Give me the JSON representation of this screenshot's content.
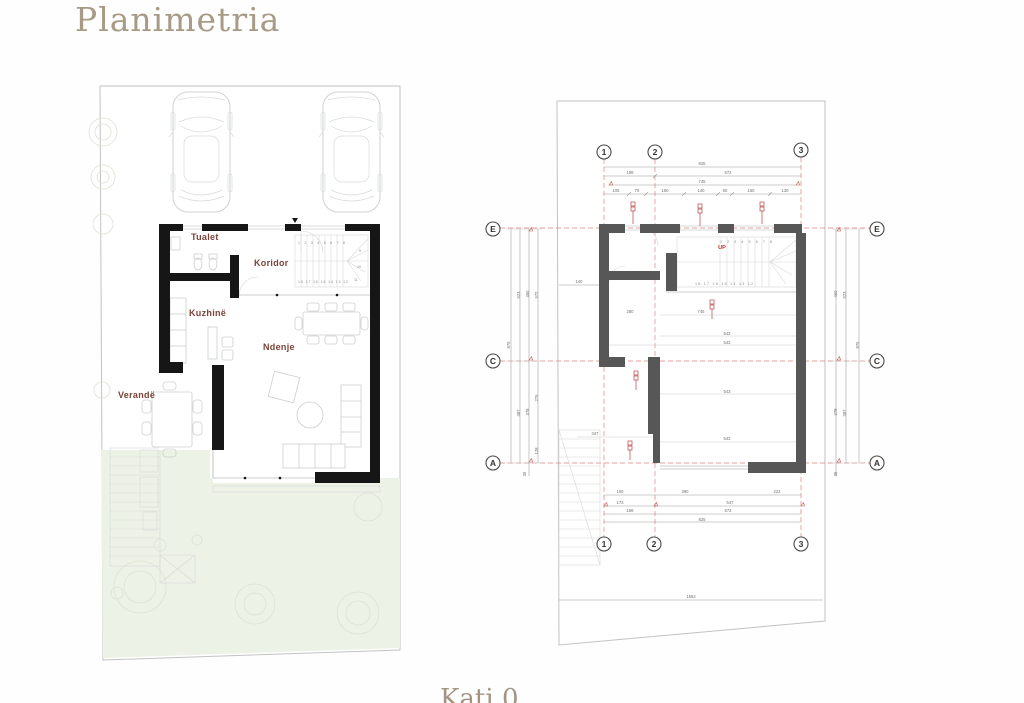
{
  "page": {
    "title": "Planimetria",
    "caption": "Kati 0",
    "colors": {
      "accent": "#a89b86",
      "room_label": "#7a4238",
      "grid_red": "#e08080",
      "tag_red": "#b84040",
      "left_plan_wall": "#161616",
      "right_plan_wall": "#575757",
      "lawn": "#edf2e6"
    }
  },
  "left_plan": {
    "room_labels": [
      "Tualet",
      "Koridor",
      "Kuzhinë",
      "Ndenje",
      "Verandë"
    ],
    "stair_top": "1 2 3 4 5 6 7 8",
    "stair_bottom": "18 17 16 15 14 13 12",
    "stair_side": [
      "9",
      "10",
      "11"
    ]
  },
  "right_plan": {
    "grid_columns": [
      "1",
      "2",
      "3"
    ],
    "grid_rows": [
      "E",
      "C",
      "A"
    ],
    "up_label": "UP",
    "stair_top": "1 2 3 4 5 6 7 8",
    "stair_bottom": "18 17 16 15 14 13 12",
    "dims": [
      {
        "t": "825",
        "x": 222,
        "y": 70
      },
      {
        "t": "198",
        "x": 150,
        "y": 79
      },
      {
        "t": "572",
        "x": 248,
        "y": 79
      },
      {
        "t": "745",
        "x": 222,
        "y": 88
      },
      {
        "t": "105",
        "x": 136,
        "y": 97
      },
      {
        "t": "70",
        "x": 157,
        "y": 97
      },
      {
        "t": "160",
        "x": 185,
        "y": 97
      },
      {
        "t": "140",
        "x": 221,
        "y": 97
      },
      {
        "t": "60",
        "x": 245,
        "y": 97
      },
      {
        "t": "160",
        "x": 271,
        "y": 97
      },
      {
        "t": "130",
        "x": 305,
        "y": 97
      },
      {
        "t": "100",
        "x": 140,
        "y": 398
      },
      {
        "t": "390",
        "x": 205,
        "y": 398
      },
      {
        "t": "222",
        "x": 297,
        "y": 398
      },
      {
        "t": "173",
        "x": 140,
        "y": 409
      },
      {
        "t": "547",
        "x": 250,
        "y": 409
      },
      {
        "t": "198",
        "x": 150,
        "y": 417
      },
      {
        "t": "572",
        "x": 248,
        "y": 417
      },
      {
        "t": "825",
        "x": 222,
        "y": 426
      },
      {
        "t": "1562",
        "x": 211,
        "y": 503
      },
      {
        "t": "875",
        "x": 30,
        "y": 250,
        "r": 1
      },
      {
        "t": "523",
        "x": 40,
        "y": 200,
        "r": 1
      },
      {
        "t": "387",
        "x": 40,
        "y": 318,
        "r": 1
      },
      {
        "t": "460",
        "x": 49,
        "y": 199,
        "r": 1
      },
      {
        "t": "378",
        "x": 49,
        "y": 317,
        "r": 1
      },
      {
        "t": "572",
        "x": 58,
        "y": 200,
        "r": 1
      },
      {
        "t": "275",
        "x": 58,
        "y": 303,
        "r": 1
      },
      {
        "t": "128",
        "x": 58,
        "y": 356,
        "r": 1
      },
      {
        "t": "35",
        "x": 46,
        "y": 379,
        "r": 1
      },
      {
        "t": "460",
        "x": 357,
        "y": 199,
        "r": 1
      },
      {
        "t": "378",
        "x": 357,
        "y": 317,
        "r": 1
      },
      {
        "t": "35",
        "x": 357,
        "y": 379,
        "r": 1
      },
      {
        "t": "523",
        "x": 366,
        "y": 200,
        "r": 1
      },
      {
        "t": "387",
        "x": 366,
        "y": 318,
        "r": 1
      },
      {
        "t": "875",
        "x": 379,
        "y": 250,
        "r": 1
      },
      {
        "t": "745",
        "x": 221,
        "y": 218
      },
      {
        "t": "280",
        "x": 150,
        "y": 218
      },
      {
        "t": "543",
        "x": 247,
        "y": 240
      },
      {
        "t": "543",
        "x": 247,
        "y": 249
      },
      {
        "t": "543",
        "x": 247,
        "y": 298
      },
      {
        "t": "543",
        "x": 247,
        "y": 345
      },
      {
        "t": "347",
        "x": 115,
        "y": 340
      },
      {
        "t": "140",
        "x": 99,
        "y": 188
      }
    ]
  }
}
